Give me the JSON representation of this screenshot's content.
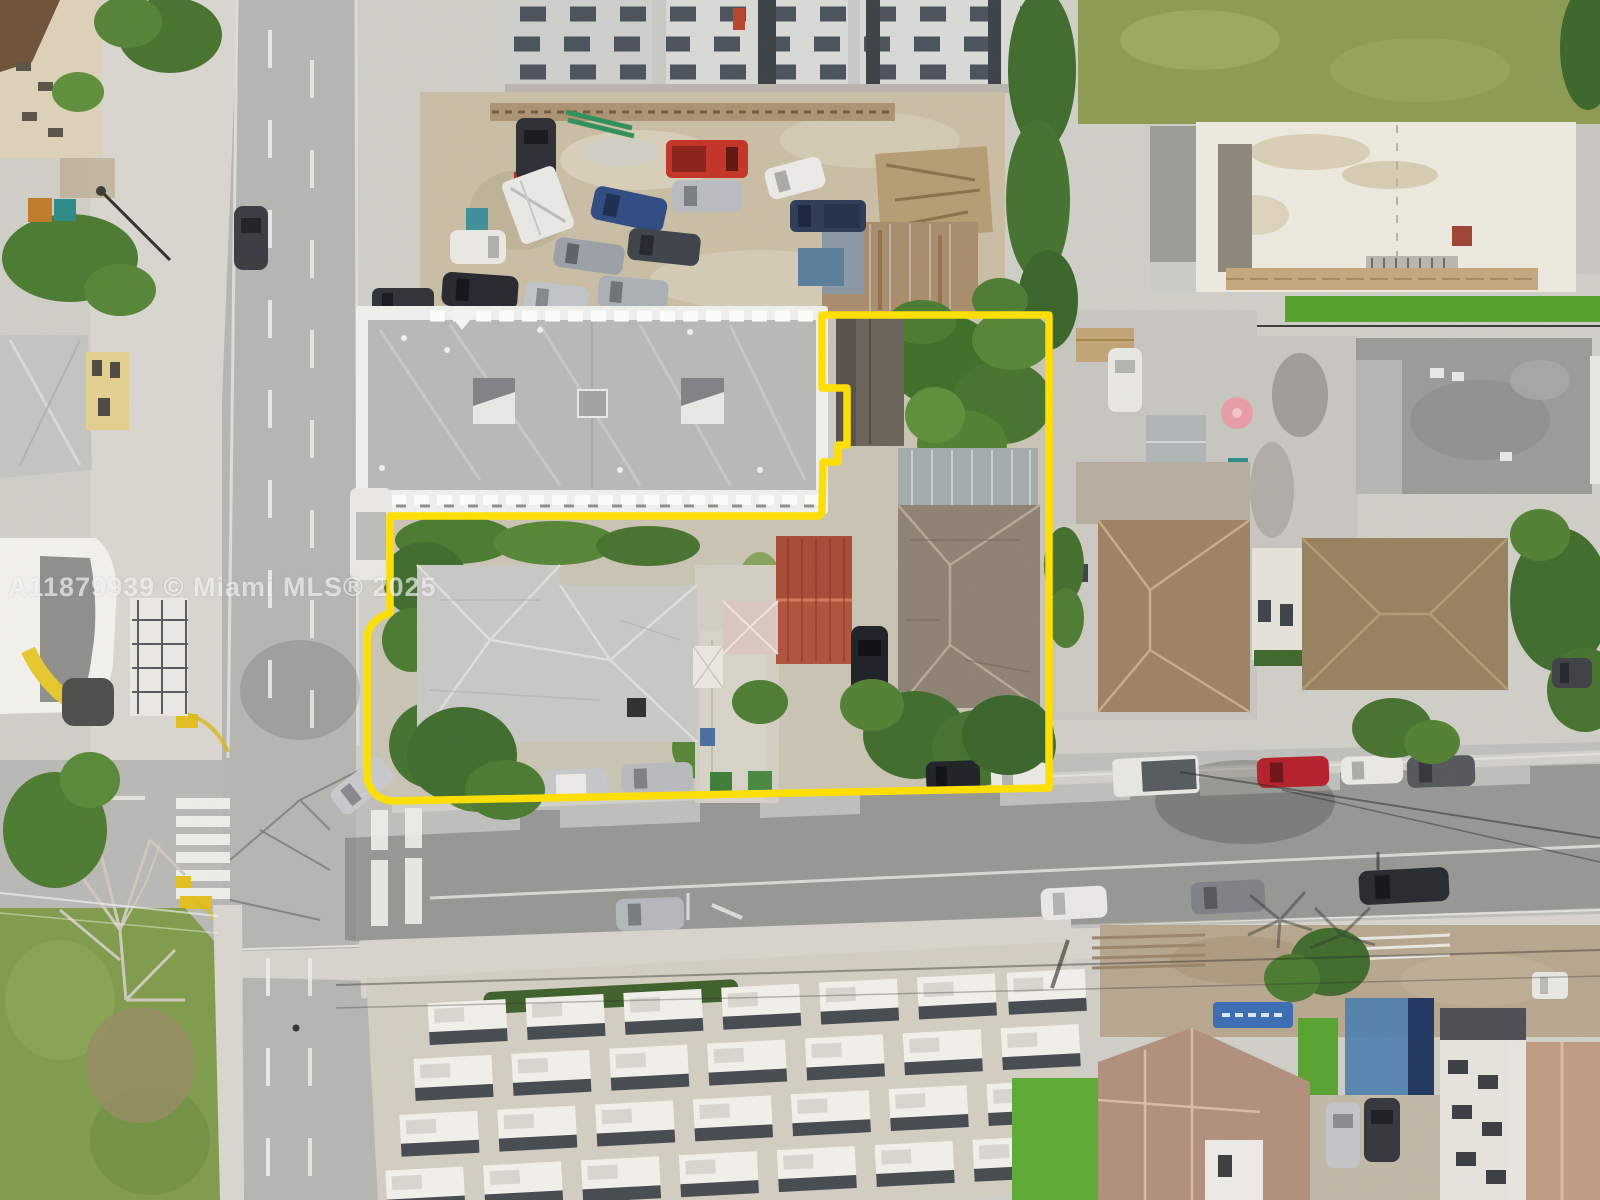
{
  "image_type": "aerial-drone-photo",
  "scene": "Top-down aerial drone photo of a Miami city block with a multi-lot property outlined in yellow",
  "watermark": {
    "text": "A11879939 © Miami MLS® 2025",
    "color": "rgba(255,255,255,0.62)"
  },
  "parcel": {
    "outline_color": "#ffe000",
    "contents": [
      "industrial-building-excluded-notch",
      "dark-gabled-cottage",
      "main-hip-roof-house",
      "gray-shingle-house",
      "red-metal-roof-building",
      "pink-shed",
      "white-shed",
      "yard-trees",
      "parked-cars-frontage"
    ]
  },
  "palette": {
    "asphalt": "#b5b6b2",
    "concrete": "#d7d5ce",
    "industrial_roof": "#b8bbb7",
    "dirt_lot": "#c9bda4",
    "lawn": "#7f9b4b",
    "turf": "#57a12d",
    "tree_green": "#47722e",
    "yellow_boundary": "#ffe000"
  }
}
